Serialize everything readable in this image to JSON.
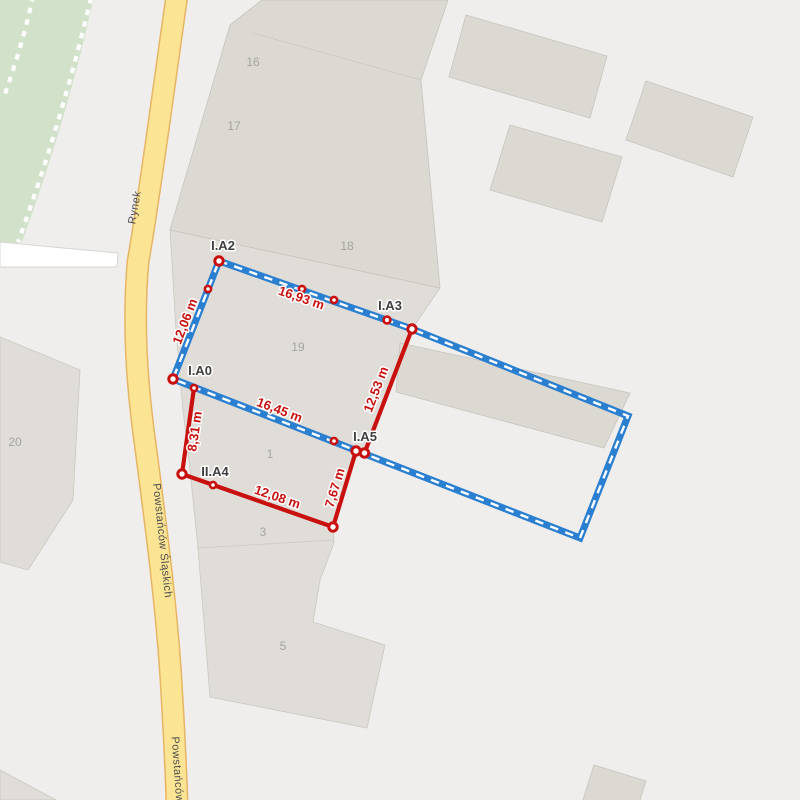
{
  "map": {
    "roads": {
      "rynek": "Rynek",
      "powstancow_slaskich": "Powstańców Śląskich",
      "powstancow": "Powstańców"
    },
    "parcels": {
      "n16": "16",
      "n17": "17",
      "n18": "18",
      "n19": "19",
      "n20": "20",
      "n1": "1",
      "n3": "3",
      "n5": "5"
    }
  },
  "survey": {
    "point_labels": {
      "ia2": "I.A2",
      "ia3": "I.A3",
      "ia0": "I.A0",
      "ia5": "I.A5",
      "iia4": "II.A4"
    },
    "measurements": {
      "top_edge": "16,93 m",
      "left_edge": "12,06 m",
      "middle_edge": "16,45 m",
      "right_segment": "12,53 m",
      "lower_left_segment": "8,31 m",
      "bottom_segment": "12,08 m",
      "inner_segment": "7,67 m"
    }
  },
  "colors": {
    "selection_blue": "#2B7FD0",
    "measure_red": "#C8100E",
    "park_green": "#D2E1CA",
    "road_yellow": "#FBE493",
    "road_casing": "#E7B566",
    "building_grey": "#DCD9D3",
    "parcel_grey": "#E0DDD8",
    "background": "#EFEEEC"
  }
}
